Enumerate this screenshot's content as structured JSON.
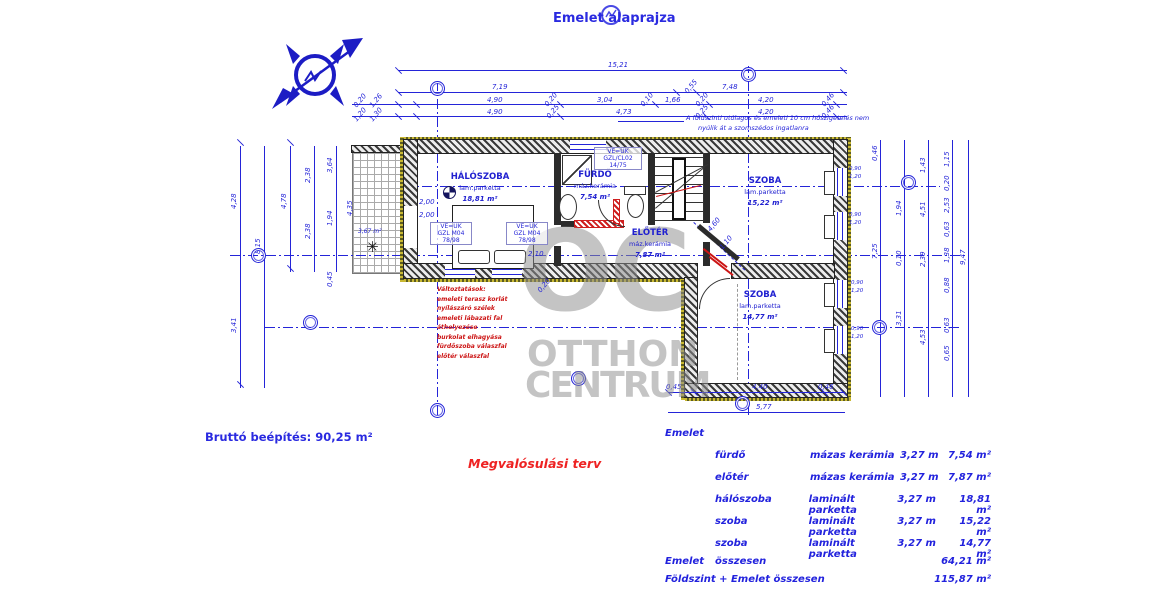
{
  "title": "Emelet alaprajza",
  "plan": {
    "rooms": {
      "haloszoba": {
        "name": "HÁLÓSZOBA",
        "finish": "lam.parketta",
        "area": "18,81 m²"
      },
      "furdo": {
        "name": "FÜRDŐ",
        "finish": "máz.kerámia",
        "area": "7,54 m²"
      },
      "eloter": {
        "name": "ELŐTÉR",
        "finish": "máz.kerámia",
        "area": "7,87 m²"
      },
      "szoba_felso": {
        "name": "SZOBA",
        "finish": "lam.parketta",
        "area": "15,22 m²"
      },
      "szoba_also": {
        "name": "SZOBA",
        "finish": "lam.parketta",
        "area": "14,77 m²"
      },
      "terasz": {
        "area": "3,67 m²"
      }
    },
    "window_labels": {
      "bed1": [
        "VE=UK",
        "GZL M04",
        "78/98"
      ],
      "bed2": [
        "VE=UK",
        "GZL M04",
        "78/98"
      ],
      "bath": [
        "VE=UK",
        "GZL/CL02",
        "14/75"
      ]
    },
    "dims": {
      "top_total": "15,21",
      "top_row2": [
        "7,19",
        "0,55",
        "7,48"
      ],
      "top_row3": [
        "4,90",
        "0,20",
        "3,04",
        "0,10",
        "1,66",
        "0,20",
        "4,20",
        "0,46"
      ],
      "top_row4": [
        "4,90",
        "0,25",
        "4,73",
        "0,25",
        "4,20",
        "0,46"
      ],
      "top_small": [
        "0,20",
        "1,26",
        "1,20",
        "1,30"
      ],
      "left": [
        "4,28",
        "3,41",
        "8,15",
        "4,78",
        "2,38",
        "2,38",
        "3,64",
        "1,94",
        "0,45",
        "4,35"
      ],
      "right_a": [
        "0,46",
        "7,25"
      ],
      "right_b": [
        "1,94",
        "0,10",
        "3,31"
      ],
      "right_c": [
        "1,43",
        "4,51",
        "2,39",
        "4,53"
      ],
      "right_d": [
        "1,15",
        "0,20",
        "2,53",
        "0,63",
        "1,38",
        "0,88",
        "0,63",
        "0,65"
      ],
      "right_e": [
        "9,47"
      ],
      "bottom": [
        "0,45",
        "4,40",
        "0,46",
        "5,77"
      ],
      "interior": [
        "2,00",
        "2,00",
        "2,10",
        "0,20",
        "4,60",
        "1,10"
      ],
      "window_sills": [
        "0,90",
        "1,20"
      ]
    }
  },
  "notes": {
    "insulation": [
      "A földszinti utólagos és emeleti 10 cm hőszigetelés nem",
      "nyúlik át a szomszédos ingatlanra"
    ],
    "changes": [
      "Változtatások:",
      "emeleti terasz korlát",
      "nyílászáró szélek",
      "emeleti lábazati fal áthelyezése",
      "burkolat elhagyása",
      "fürdőszoba válaszfal",
      "előtér válaszfal"
    ],
    "plan_type": "Megvalósulási terv",
    "gross": "Bruttó beépítés: 90,25 m²"
  },
  "watermark": {
    "initials": "OC",
    "line1": "OTTHON",
    "line2": "CENTRUM"
  },
  "summary": {
    "section": "Emelet",
    "rows": [
      {
        "room": "fürdő",
        "finish": "mázas kerámia",
        "height": "3,27 m",
        "area": "7,54 m²"
      },
      {
        "room": "előtér",
        "finish": "mázas kerámia",
        "height": "3,27 m",
        "area": "7,87 m²"
      },
      {
        "room": "hálószoba",
        "finish": "laminált parketta",
        "height": "3,27 m",
        "area": "18,81 m²"
      },
      {
        "room": "szoba",
        "finish": "laminált parketta",
        "height": "3,27 m",
        "area": "15,22 m²"
      },
      {
        "room": "szoba",
        "finish": "laminált parketta",
        "height": "3,27 m",
        "area": "14,77 m²"
      }
    ],
    "total": {
      "label1": "Emelet",
      "label2": "összesen",
      "value": "64,21 m²"
    },
    "grand": {
      "label": "Földszint + Emelet összesen",
      "value": "115,87 m²"
    }
  },
  "colors": {
    "blueprint": "#2424d8",
    "change_red": "#cc1414",
    "watermark_gray": "#8f8f8f"
  }
}
